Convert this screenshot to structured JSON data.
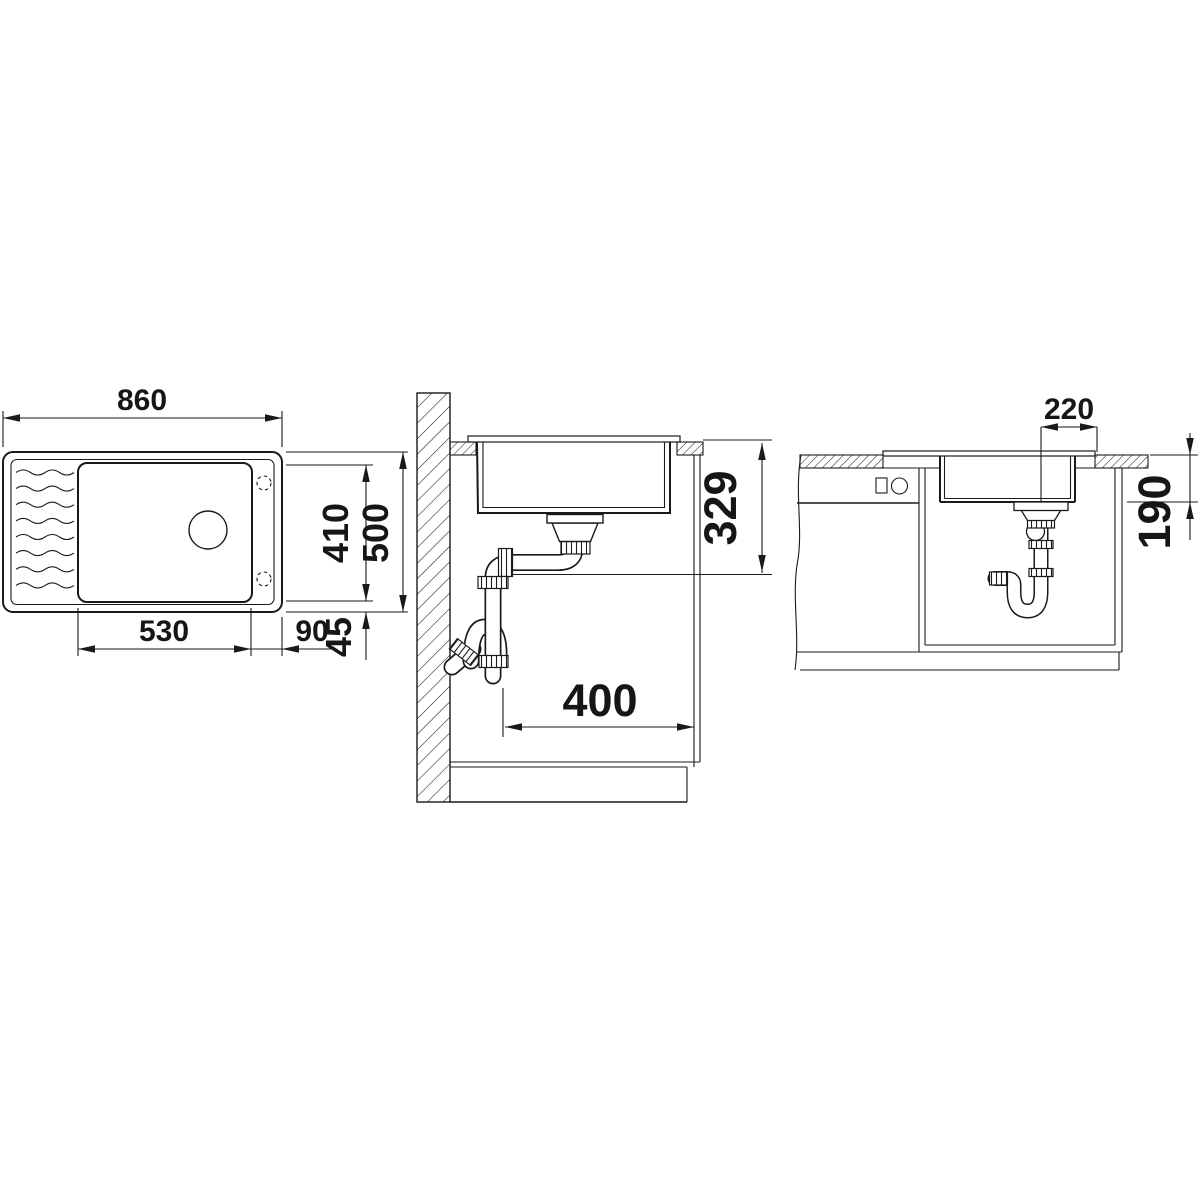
{
  "colors": {
    "line": "#1a1a1a",
    "background": "#ffffff"
  },
  "dimensions": {
    "top_view": {
      "overall_width": "860",
      "bowl_depth": "410",
      "overall_depth": "500",
      "bowl_width": "530",
      "bowl_to_right_edge": "90",
      "bowl_to_edge_offset": "45"
    },
    "section_view": {
      "drain_height_below_top": "329",
      "trap_offset_from_wall": "400"
    },
    "front_view": {
      "drain_to_cutout_edge": "220",
      "bowl_depth_below_top": "190"
    }
  }
}
